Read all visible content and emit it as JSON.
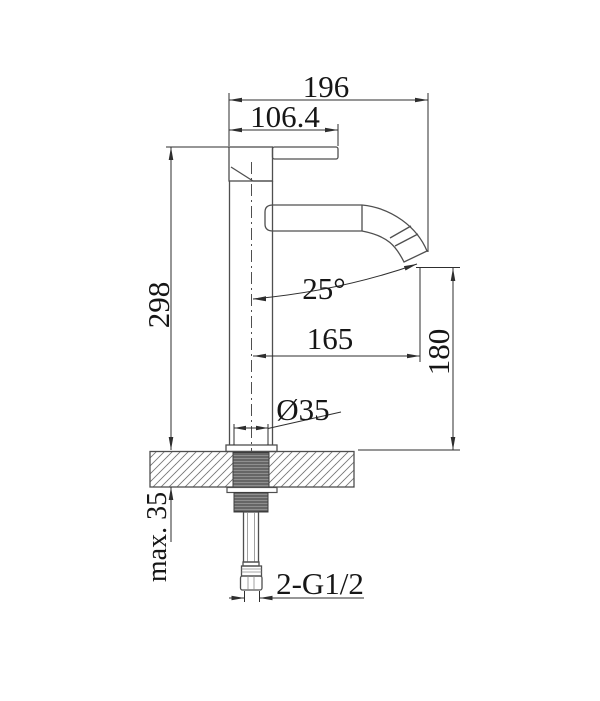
{
  "drawing": {
    "dimensions": {
      "overall_width": "196",
      "handle_length": "106.4",
      "body_height": "298",
      "spout_angle": "25°",
      "spout_reach": "165",
      "spout_outlet_height": "180",
      "shank_diameter": "Ø35",
      "deck_thickness": "max. 35",
      "inlet_thread": "2-G1/2"
    },
    "colors": {
      "background": "#ffffff",
      "outline": "#4f4f4f",
      "dimension": "#2e2e2e",
      "text": "#161616",
      "thread_fill": "#8f8f8f",
      "hatch": "#777777"
    }
  }
}
